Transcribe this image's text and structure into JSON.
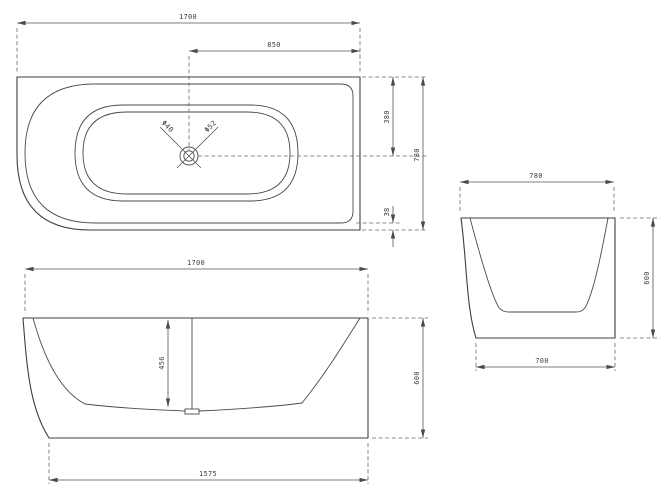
{
  "views": {
    "top": {
      "dims": {
        "overall_length": "1700",
        "drain_offset": "850",
        "drain_from_back": "380",
        "overall_width": "780",
        "rim_lip": "38",
        "drain_label_left": "Φ40",
        "drain_label_right": "Φ52"
      }
    },
    "front": {
      "dims": {
        "overall_length": "1700",
        "inner_depth": "456",
        "overall_height": "600",
        "base_length": "1575"
      }
    },
    "side": {
      "dims": {
        "overall_width": "780",
        "overall_height": "600",
        "base_width": "700"
      }
    }
  },
  "colors": {
    "line": "#3f3f3f",
    "dimension": "#555555",
    "background": "#ffffff"
  }
}
